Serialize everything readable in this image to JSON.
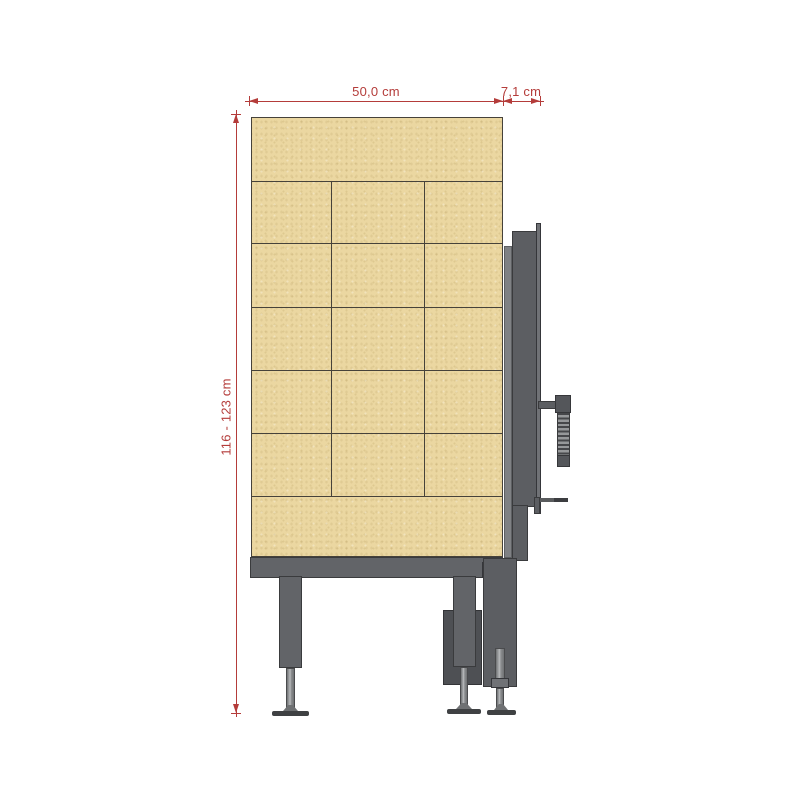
{
  "drawing": {
    "type": "technical-side-view-tiled-stove",
    "annotations": {
      "width_label": "50,0 cm",
      "depth_label": "7,1 cm",
      "height_label": "116 - 123 cm"
    },
    "colors": {
      "dimension_red": "#b43c3a",
      "tile_tan": "#ebd7a1",
      "grid_line": "#46423a",
      "frame_gray": "#626468",
      "frame_dark": "#54565a",
      "frame_light": "#7f8184",
      "stem_metal": "#b9bbbd",
      "background": "#ffffff"
    },
    "tile_grid": {
      "row_line_offsets": [
        63,
        125,
        189,
        252,
        315,
        378
      ],
      "col_line_offsets": [
        79,
        172
      ],
      "col_line_top": 63,
      "col_line_bottom": 378
    }
  }
}
